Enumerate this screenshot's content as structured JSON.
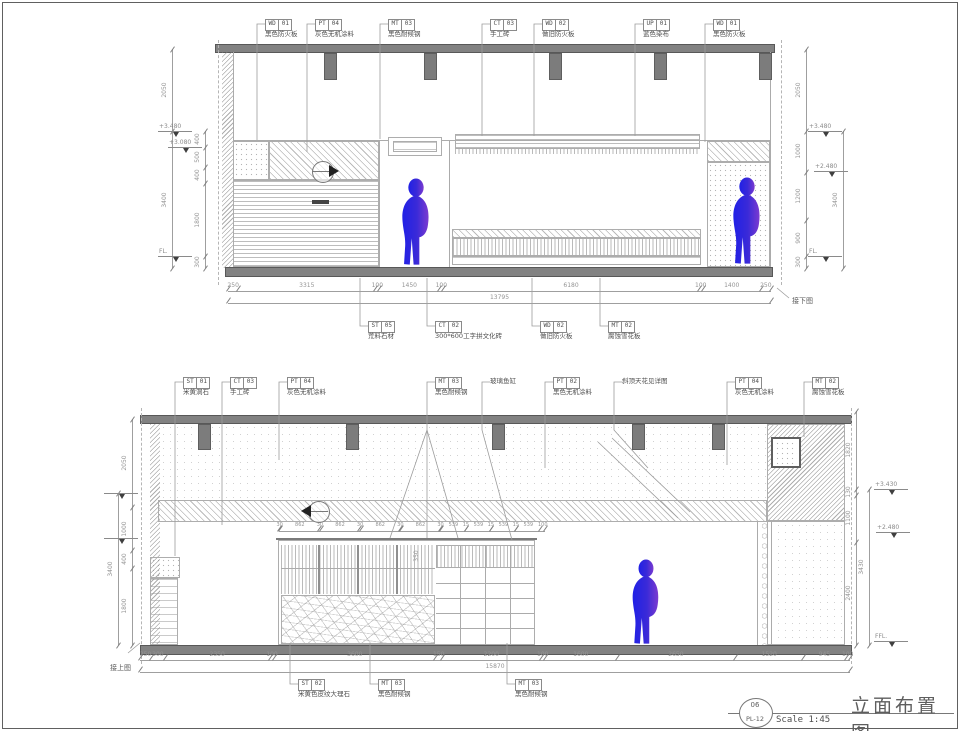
{
  "sheet": {
    "title": "立面布置图",
    "number": "06",
    "code": "PL-12",
    "scale": "Scale 1:45"
  },
  "palette": {
    "line_gray": "#9a9a9a",
    "fill_gray": "#828282",
    "dim_text": "#949494",
    "callout_text": "#4e4e4e",
    "figure_blue": "#2020e6",
    "figure_purple": "#7c3bd0"
  },
  "elev_top": {
    "callouts_top": [
      {
        "code": "WD",
        "num": "01",
        "label": "黑色防火板",
        "lx": 257,
        "ty": 140
      },
      {
        "code": "PT",
        "num": "04",
        "label": "灰色无机涂料",
        "lx": 307,
        "ty": 152
      },
      {
        "code": "MT",
        "num": "03",
        "label": "黑色耐候钢",
        "lx": 380,
        "ty": 139
      },
      {
        "code": "CT",
        "num": "03",
        "label": "手工砖",
        "lx": 482,
        "ty": 136
      },
      {
        "code": "WD",
        "num": "02",
        "label": "做旧防火板",
        "lx": 534,
        "ty": 136
      },
      {
        "code": "UP",
        "num": "01",
        "label": "蓝色染布",
        "lx": 635,
        "ty": 136
      },
      {
        "code": "WD",
        "num": "01",
        "label": "黑色防火板",
        "lx": 705,
        "ty": 142
      }
    ],
    "callouts_bottom": [
      {
        "code": "ST",
        "num": "05",
        "label": "荒料石材",
        "lx": 360,
        "ty": 278
      },
      {
        "code": "CT",
        "num": "02",
        "label": "300*600工字拼文化砖",
        "lx": 427,
        "ty": 278
      },
      {
        "code": "WD",
        "num": "02",
        "label": "做旧防火板",
        "lx": 532,
        "ty": 278
      },
      {
        "code": "MT",
        "num": "02",
        "label": "腐蚀雪花板",
        "lx": 600,
        "ty": 278
      }
    ],
    "chains": [
      {
        "dir": "h",
        "x": 228,
        "y": 291,
        "len": 543,
        "values": [
          "250",
          "3315",
          "100",
          "1450",
          "100",
          "6180",
          "100",
          "1400",
          "250"
        ]
      },
      {
        "dir": "h",
        "x": 228,
        "y": 303,
        "len": 543,
        "values": [
          "13795"
        ]
      },
      {
        "dir": "v",
        "x": 172,
        "y": 49,
        "len": 219,
        "values": [
          "2050",
          "3400"
        ]
      },
      {
        "dir": "v",
        "x": 205,
        "y": 131,
        "len": 137,
        "values": [
          "400",
          "500",
          "400",
          "1800",
          "300"
        ]
      },
      {
        "dir": "v",
        "x": 806,
        "y": 49,
        "len": 219,
        "values": [
          "2050",
          "1000",
          "1200",
          "900",
          "300"
        ]
      },
      {
        "dir": "v",
        "x": 843,
        "y": 131,
        "len": 137,
        "values": [
          "3400"
        ]
      }
    ],
    "levels": [
      {
        "text": "+3.480",
        "x": 158,
        "y": 131
      },
      {
        "text": "+3.080",
        "x": 168,
        "y": 147
      },
      {
        "text": "FL.",
        "x": 158,
        "y": 256
      },
      {
        "text": "+3.480",
        "x": 808,
        "y": 131
      },
      {
        "text": "+2.480",
        "x": 814,
        "y": 171
      },
      {
        "text": "FL.",
        "x": 808,
        "y": 256
      }
    ],
    "markers": [
      {
        "x": 322,
        "y": 171,
        "dir": "right"
      }
    ],
    "figures": [
      {
        "x": 394,
        "y": 177,
        "w": 44,
        "h": 90
      },
      {
        "x": 725,
        "y": 175,
        "w": 44,
        "h": 92
      }
    ],
    "note": {
      "text": "接下图",
      "x": 792,
      "y": 296,
      "slash": [
        777,
        288,
        789,
        298
      ]
    }
  },
  "elev_bottom": {
    "callouts_top": [
      {
        "code": "ST",
        "num": "01",
        "label": "米黄洞石",
        "lx": 175,
        "ty": 556
      },
      {
        "code": "CT",
        "num": "03",
        "label": "手工砖",
        "lx": 222,
        "ty": 525
      },
      {
        "code": "PT",
        "num": "04",
        "label": "灰色无机涂料",
        "lx": 279,
        "ty": 460
      },
      {
        "code": "MT",
        "num": "03",
        "label": "黑色耐候钢",
        "lx": 427,
        "ty": 538
      },
      {
        "label": "玻璃鱼缸",
        "lx": 482,
        "my": 430,
        "tx": 512,
        "ty": 540
      },
      {
        "code": "PT",
        "num": "02",
        "label": "黑色无机涂料",
        "lx": 545,
        "ty": 468
      },
      {
        "label": "斜顶天花见详图",
        "lx": 614,
        "my": 430,
        "tx": 648,
        "ty": 468
      },
      {
        "code": "PT",
        "num": "04",
        "label": "灰色无机涂料",
        "lx": 727,
        "ty": 465
      },
      {
        "code": "MT",
        "num": "02",
        "label": "腐蚀雪花板",
        "lx": 804,
        "ty": 437
      }
    ],
    "callouts_bottom": [
      {
        "code": "ST",
        "num": "02",
        "label": "米黄色皮纹大理石",
        "lx": 290,
        "ty": 643
      },
      {
        "code": "MT",
        "num": "03",
        "label": "黑色耐候钢",
        "lx": 370,
        "ty": 643
      },
      {
        "code": "MT",
        "num": "03",
        "label": "黑色耐候钢",
        "lx": 507,
        "ty": 643
      }
    ],
    "chains": [
      {
        "dir": "h",
        "x": 279,
        "y": 531,
        "len": 266,
        "small": true,
        "values": [
          "30",
          "862",
          "30",
          "862",
          "30",
          "862",
          "30",
          "862",
          "30",
          "539",
          "15",
          "539",
          "15",
          "539",
          "15",
          "539",
          "100"
        ]
      },
      {
        "dir": "h",
        "x": 140,
        "y": 660,
        "len": 710,
        "values": [
          "250",
          "300",
          "2350",
          "100",
          "3600",
          "150",
          "2200",
          "100",
          "1600",
          "2650",
          "1520",
          "945",
          "100"
        ]
      },
      {
        "dir": "h",
        "x": 140,
        "y": 672,
        "len": 710,
        "values": [
          "15870"
        ]
      },
      {
        "dir": "v",
        "x": 132,
        "y": 419,
        "len": 226,
        "values": [
          "2050",
          "1000",
          "400",
          "1800"
        ]
      },
      {
        "dir": "v",
        "x": 118,
        "y": 493,
        "len": 152,
        "values": [
          "3400"
        ]
      },
      {
        "dir": "v",
        "x": 856,
        "y": 411,
        "len": 234,
        "values": [
          "1820",
          "130",
          "1100",
          "2400"
        ]
      },
      {
        "dir": "v",
        "x": 869,
        "y": 489,
        "len": 156,
        "values": [
          "3430"
        ]
      }
    ],
    "levels": [
      {
        "text": "+3.430",
        "x": 874,
        "y": 489
      },
      {
        "text": "+2.480",
        "x": 876,
        "y": 532
      },
      {
        "text": "FFL.",
        "x": 874,
        "y": 641
      },
      {
        "text": "",
        "x": 104,
        "y": 493
      },
      {
        "text": "",
        "x": 104,
        "y": 538
      }
    ],
    "inner_dims": [
      {
        "text": "350",
        "x": 417,
        "y": 556
      }
    ],
    "markers": [
      {
        "x": 318,
        "y": 511,
        "dir": "left"
      }
    ],
    "figures": [
      {
        "x": 624,
        "y": 559,
        "w": 44,
        "h": 86
      }
    ],
    "note": {
      "text": "接上图",
      "x": 110,
      "y": 663,
      "slash": [
        128,
        653,
        140,
        643
      ]
    }
  },
  "lines": [
    {
      "x1": 427,
      "y1": 430,
      "x2": 390,
      "y2": 538
    },
    {
      "x1": 427,
      "y1": 430,
      "x2": 458,
      "y2": 538
    },
    {
      "x1": 598,
      "y1": 442,
      "x2": 678,
      "y2": 518
    },
    {
      "x1": 612,
      "y1": 438,
      "x2": 690,
      "y2": 512
    }
  ]
}
